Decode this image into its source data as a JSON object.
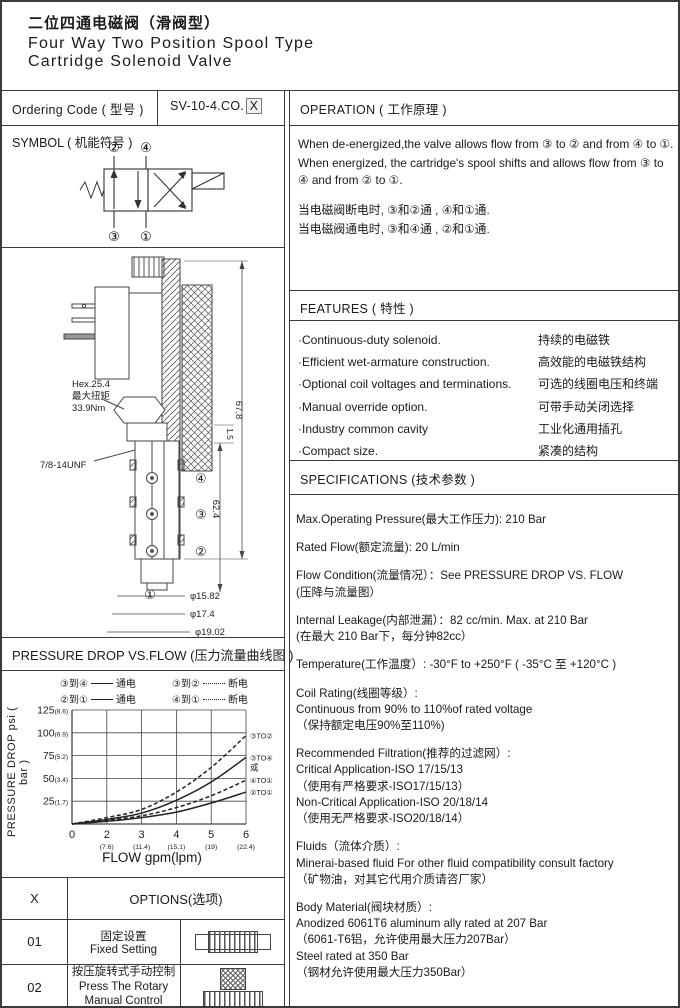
{
  "header": {
    "title_cn": "二位四通电磁阀（滑阀型）",
    "title_en_line1": "Four Way Two Position Spool Type",
    "title_en_line2": "Cartridge Solenoid Valve"
  },
  "ordering": {
    "label": "Ordering Code ( 型号 )",
    "code": "SV-10-4.CO.",
    "code_variant": "X"
  },
  "symbol": {
    "title": "SYMBOL ( 机能符号 )",
    "ports": {
      "p2": "②",
      "p4": "④",
      "p3": "③",
      "p1": "①"
    }
  },
  "operation": {
    "title": "OPERATION ( 工作原理 )",
    "paragraphs": [
      "When de-energized,the valve allows flow from ③ to ② and from ④ to ①.",
      "When energized, the cartridge's spool shifts and allows flow from ③ to ④ and from ② to ①.",
      "当电磁阀断电时, ③和②通 , ④和①通.",
      "当电磁阀通电时, ③和④通 , ②和①通."
    ]
  },
  "features": {
    "title": "FEATURES ( 特性 )",
    "items": [
      {
        "en": "·Continuous-duty  solenoid.",
        "cn": "持续的电磁铁"
      },
      {
        "en": "·Efficient wet-armature construction.",
        "cn": "高效能的电磁铁结构"
      },
      {
        "en": "·Optional coil voltages and terminations.",
        "cn": "可选的线圈电压和终端"
      },
      {
        "en": "·Manual override option.",
        "cn": "可带手动关闭选择"
      },
      {
        "en": "·Industry common cavity",
        "cn": "工业化通用插孔"
      },
      {
        "en": "·Compact size.",
        "cn": "紧凑的结构"
      }
    ]
  },
  "specifications": {
    "title": "SPECIFICATIONS (技术参数 )",
    "items": [
      [
        "Max.Operating Pressure(最大工作压力): 210 Bar"
      ],
      [
        "Rated Flow(额定流量): 20 L/min"
      ],
      [
        "Flow Condition(流量情况）：See PRESSURE DROP VS. FLOW",
        "(压降与流量图）"
      ],
      [
        "Internal Leakage(内部泄漏）：82 cc/min. Max. at 210 Bar",
        "(在最大 210 Bar下，每分钟82cc）"
      ],
      [
        "Temperature(工作温度）: -30°F to +250°F  ( -35°C 至 +120°C )"
      ],
      [
        "Coil Rating(线圈等级）:",
        "Continuous from 90% to 110%of rated voltage",
        "（保持额定电压90%至110%)"
      ],
      [
        "Recommended Filtration(推荐的过滤网）:",
        "Critical Application-ISO 17/15/13",
        "（使用有严格要求-ISO17/15/13）",
        "Non-Critical Application-ISO 20/18/14",
        "（使用无严格要求-ISO20/18/14）"
      ],
      [
        "Fluids（流体介质）:",
        "Minerai-based fluid For other  fluid compatibility consult  factory",
        "（矿物油，对其它代用介质请咨厂家）"
      ],
      [
        "Body Material(阀块材质）:",
        "Anodized 6061T6 aluminum ally rated at 207 Bar",
        "（6061-T6铝，允许使用最大压力207Bar）",
        "Steel rated at 350 Bar",
        "（钢材允许使用最大压力350Bar）"
      ]
    ]
  },
  "drawing": {
    "hex_note": [
      "Hex.25.4",
      "最大扭矩",
      "33.9Nm"
    ],
    "thread": "7/8-14UNF",
    "dim_total": "67.8",
    "dim_body": "62.4",
    "dim_small": "1.5",
    "dia": [
      "φ15.82",
      "φ17.4",
      "φ19.02"
    ],
    "ports": {
      "p4": "④",
      "p3": "③",
      "p2": "②",
      "p1": "①"
    }
  },
  "pressure_chart": {
    "title": "PRESSURE DROP VS.FLOW  (压力流量曲线图 )",
    "ylabel": "PRESSURE DROP psi ( bar )",
    "xlabel": "FLOW gpm(lpm)",
    "legend": [
      {
        "pair": "③到④",
        "style": "solid",
        "state": "通电"
      },
      {
        "pair": "③到②",
        "style": "dashed",
        "state": "断电"
      },
      {
        "pair": "②到①",
        "style": "solid",
        "state": "通电"
      },
      {
        "pair": "④到①",
        "style": "dashed",
        "state": "断电"
      }
    ]
  },
  "chart_data": {
    "type": "line",
    "title": "PRESSURE DROP VS.FLOW (压力流量曲线图)",
    "xlabel": "FLOW gpm(lpm)",
    "ylabel": "PRESSURE DROP psi ( bar )",
    "ylim": [
      0,
      125
    ],
    "grid": true,
    "legend_position": "top",
    "x_gpm_values": [
      0,
      2,
      3,
      4,
      5,
      6
    ],
    "x_ticks": [
      {
        "label": "0",
        "sub": ""
      },
      {
        "label": "2",
        "sub": "(7.6)"
      },
      {
        "label": "3",
        "sub": "(11.4)"
      },
      {
        "label": "4",
        "sub": "(15.1)"
      },
      {
        "label": "5",
        "sub": "(19)"
      },
      {
        "label": "6",
        "sub": "(22.4)"
      }
    ],
    "y_ticks": [
      {
        "value": 25,
        "label": "25",
        "sub": "(1.7)"
      },
      {
        "value": 50,
        "label": "50",
        "sub": "(3.4)"
      },
      {
        "value": 75,
        "label": "75",
        "sub": "(5.2)"
      },
      {
        "value": 100,
        "label": "100",
        "sub": "(6.9)"
      },
      {
        "value": 125,
        "label": "125",
        "sub": "(8.6)"
      }
    ],
    "series": [
      {
        "name": "③TO②",
        "style": "dashed",
        "state": "断电",
        "values": [
          0,
          7,
          16,
          35,
          62,
          97
        ]
      },
      {
        "name": "③TO④",
        "name2": "或",
        "style": "solid",
        "state": "通电",
        "values": [
          0,
          5,
          12,
          26,
          46,
          73
        ]
      },
      {
        "name": "④TO①",
        "style": "dashed",
        "state": "断电",
        "values": [
          0,
          4,
          9,
          18,
          31,
          48
        ]
      },
      {
        "name": "②TO①",
        "style": "solid",
        "state": "通电",
        "values": [
          0,
          3,
          7,
          13,
          23,
          35
        ]
      }
    ]
  },
  "options": {
    "col_x": "X",
    "col_options": "OPTIONS(选项)",
    "rows": [
      {
        "code": "01",
        "cn": "固定设置",
        "en": "Fixed Setting",
        "en2": ""
      },
      {
        "code": "02",
        "cn": "按压旋转式手动控制",
        "en": "Press The Rotary",
        "en2": "Manual Control"
      }
    ]
  }
}
